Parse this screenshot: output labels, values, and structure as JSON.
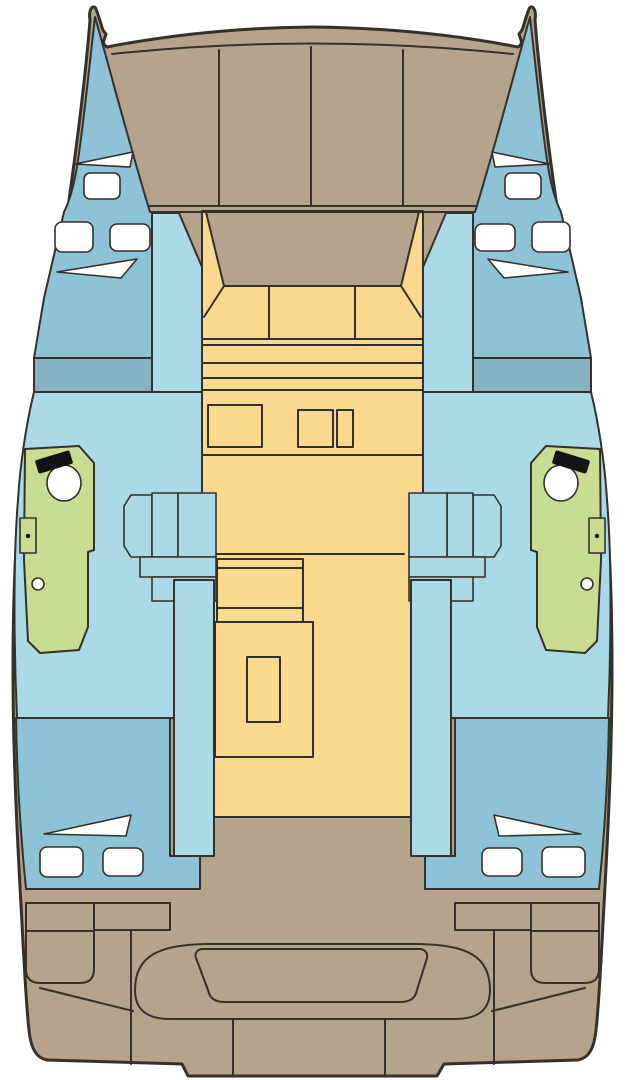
{
  "colors": {
    "background": "#ffffff",
    "outline": "#34302a",
    "deck": "#b5a48b",
    "cabin_blue": "#8ec2d6",
    "interior_blue": "#abd9e7",
    "berth_blue": "#87b2c3",
    "salon_yellow": "#f9d88f",
    "head_green": "#c9dd92",
    "fixture_white": "#ffffff",
    "fixture_black": "#141414"
  }
}
